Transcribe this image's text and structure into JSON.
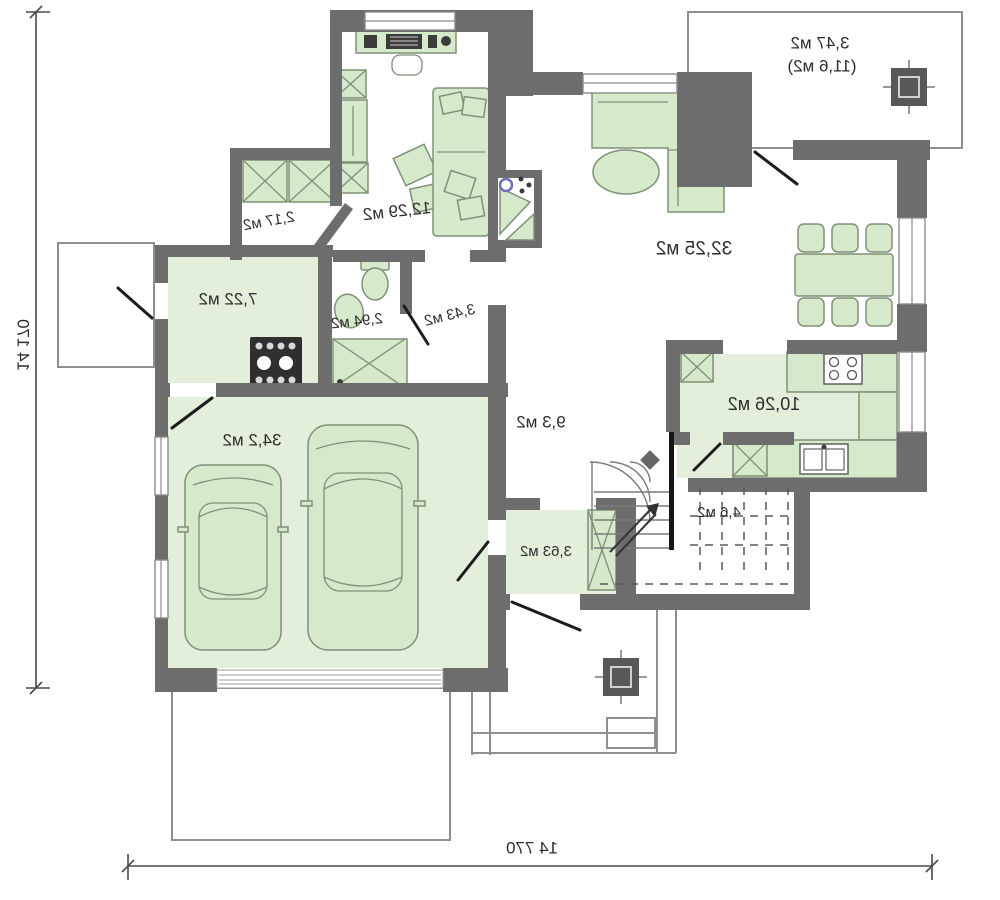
{
  "colors": {
    "wall": "#6d6d6d",
    "floor": "#e3eedb",
    "furn": "#d7e9cb",
    "furnstroke": "#7e9076",
    "accent-blue": "#7070c0"
  },
  "plan": {
    "rooms": {
      "upper_terrace": {
        "area": "3,47 м2",
        "area_total": "(11,6 м2)"
      },
      "living_room": {
        "area": "32,25 м2"
      },
      "cabinet": {
        "area": "12,29 м2"
      },
      "closet": {
        "area": "2,17 м2"
      },
      "boiler_room": {
        "area": "7,22 м2"
      },
      "bathroom": {
        "area": "2,94 м2"
      },
      "hall_small": {
        "area": "3,43 м2"
      },
      "hallway": {
        "area": "9,3 м2"
      },
      "kitchen": {
        "area": "10,26 м2"
      },
      "garage": {
        "area": "34,2 м2"
      },
      "stairs": {
        "area": "4,6 м2"
      },
      "vestibule": {
        "area": "3,63 м2"
      }
    },
    "dimensions": {
      "width": "14 770",
      "height": "14 170"
    }
  }
}
